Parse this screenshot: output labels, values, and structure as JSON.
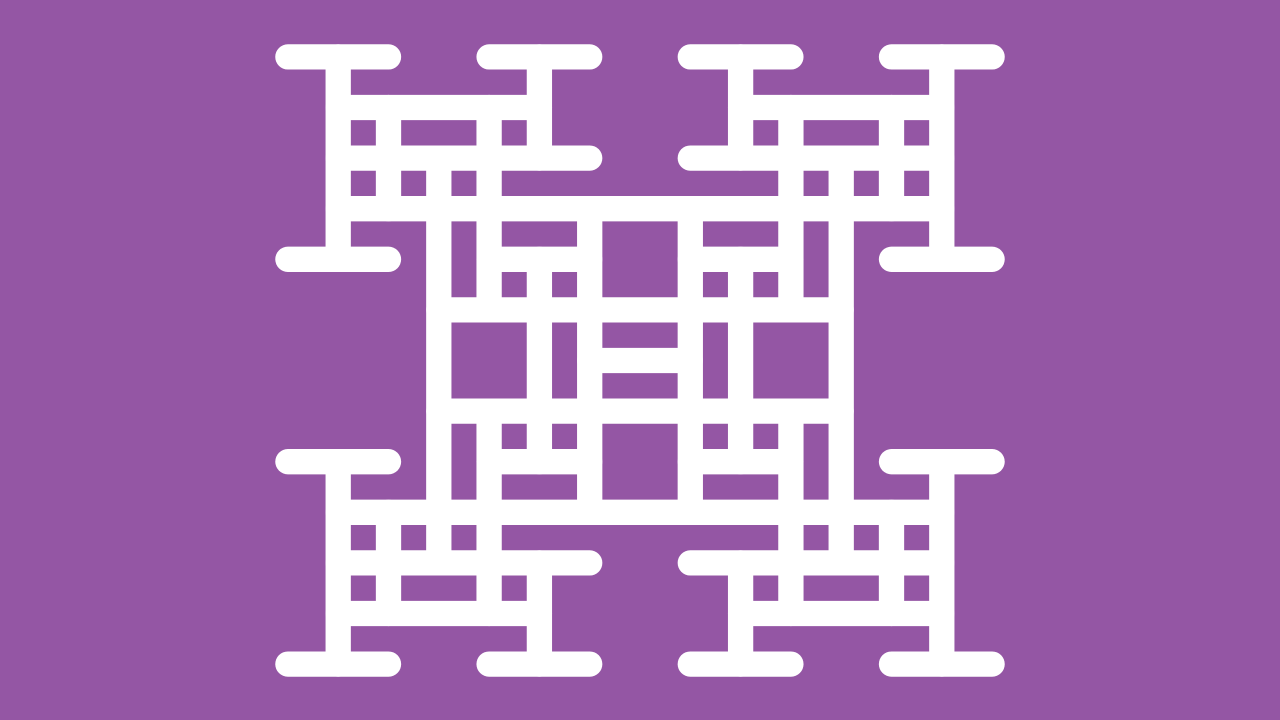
{
  "figure": {
    "name": "recursive-h-lattice-fractal",
    "background_color": "#9456A4",
    "stroke_color": "#FFFFFF",
    "canvas": {
      "width": 1280,
      "height": 720
    },
    "lattice": {
      "cx": 640,
      "cy": 360.5,
      "ux": 50.3,
      "uy": 50.6,
      "stroke_width": 25.3,
      "linecap": "round"
    },
    "segments": {
      "horizontal": [
        [
          -6,
          -7,
          -5
        ],
        [
          -6,
          -3,
          -1
        ],
        [
          -6,
          1,
          3
        ],
        [
          -6,
          5,
          7
        ],
        [
          -5,
          -6,
          -2
        ],
        [
          -5,
          2,
          6
        ],
        [
          -4,
          -6,
          -1
        ],
        [
          -4,
          1,
          6
        ],
        [
          -3,
          -6,
          6
        ],
        [
          -2,
          -7,
          -5
        ],
        [
          -2,
          -3,
          -1
        ],
        [
          -2,
          1,
          3
        ],
        [
          -2,
          5,
          7
        ],
        [
          -1,
          -4,
          4
        ],
        [
          0,
          -1,
          1
        ],
        [
          1,
          -4,
          4
        ],
        [
          2,
          -7,
          -5
        ],
        [
          2,
          -3,
          -1
        ],
        [
          2,
          1,
          3
        ],
        [
          2,
          5,
          7
        ],
        [
          3,
          -6,
          6
        ],
        [
          4,
          -6,
          -1
        ],
        [
          4,
          1,
          6
        ],
        [
          5,
          -6,
          -2
        ],
        [
          5,
          2,
          6
        ],
        [
          6,
          -7,
          -5
        ],
        [
          6,
          -3,
          -1
        ],
        [
          6,
          1,
          3
        ],
        [
          6,
          5,
          7
        ]
      ],
      "vertical": [
        [
          -6,
          -6,
          -2
        ],
        [
          -6,
          2,
          6
        ],
        [
          -5,
          -5,
          -3
        ],
        [
          -5,
          3,
          5
        ],
        [
          -4,
          -4,
          4
        ],
        [
          -3,
          -5,
          -1
        ],
        [
          -3,
          1,
          5
        ],
        [
          -2,
          -6,
          -4
        ],
        [
          -2,
          -2,
          2
        ],
        [
          -2,
          4,
          6
        ],
        [
          -1,
          -3,
          3
        ],
        [
          1,
          -3,
          3
        ],
        [
          2,
          -6,
          -4
        ],
        [
          2,
          -2,
          2
        ],
        [
          2,
          4,
          6
        ],
        [
          3,
          -5,
          -1
        ],
        [
          3,
          1,
          5
        ],
        [
          4,
          -4,
          4
        ],
        [
          5,
          -5,
          -3
        ],
        [
          5,
          3,
          5
        ],
        [
          6,
          -6,
          -2
        ],
        [
          6,
          2,
          6
        ]
      ]
    }
  }
}
